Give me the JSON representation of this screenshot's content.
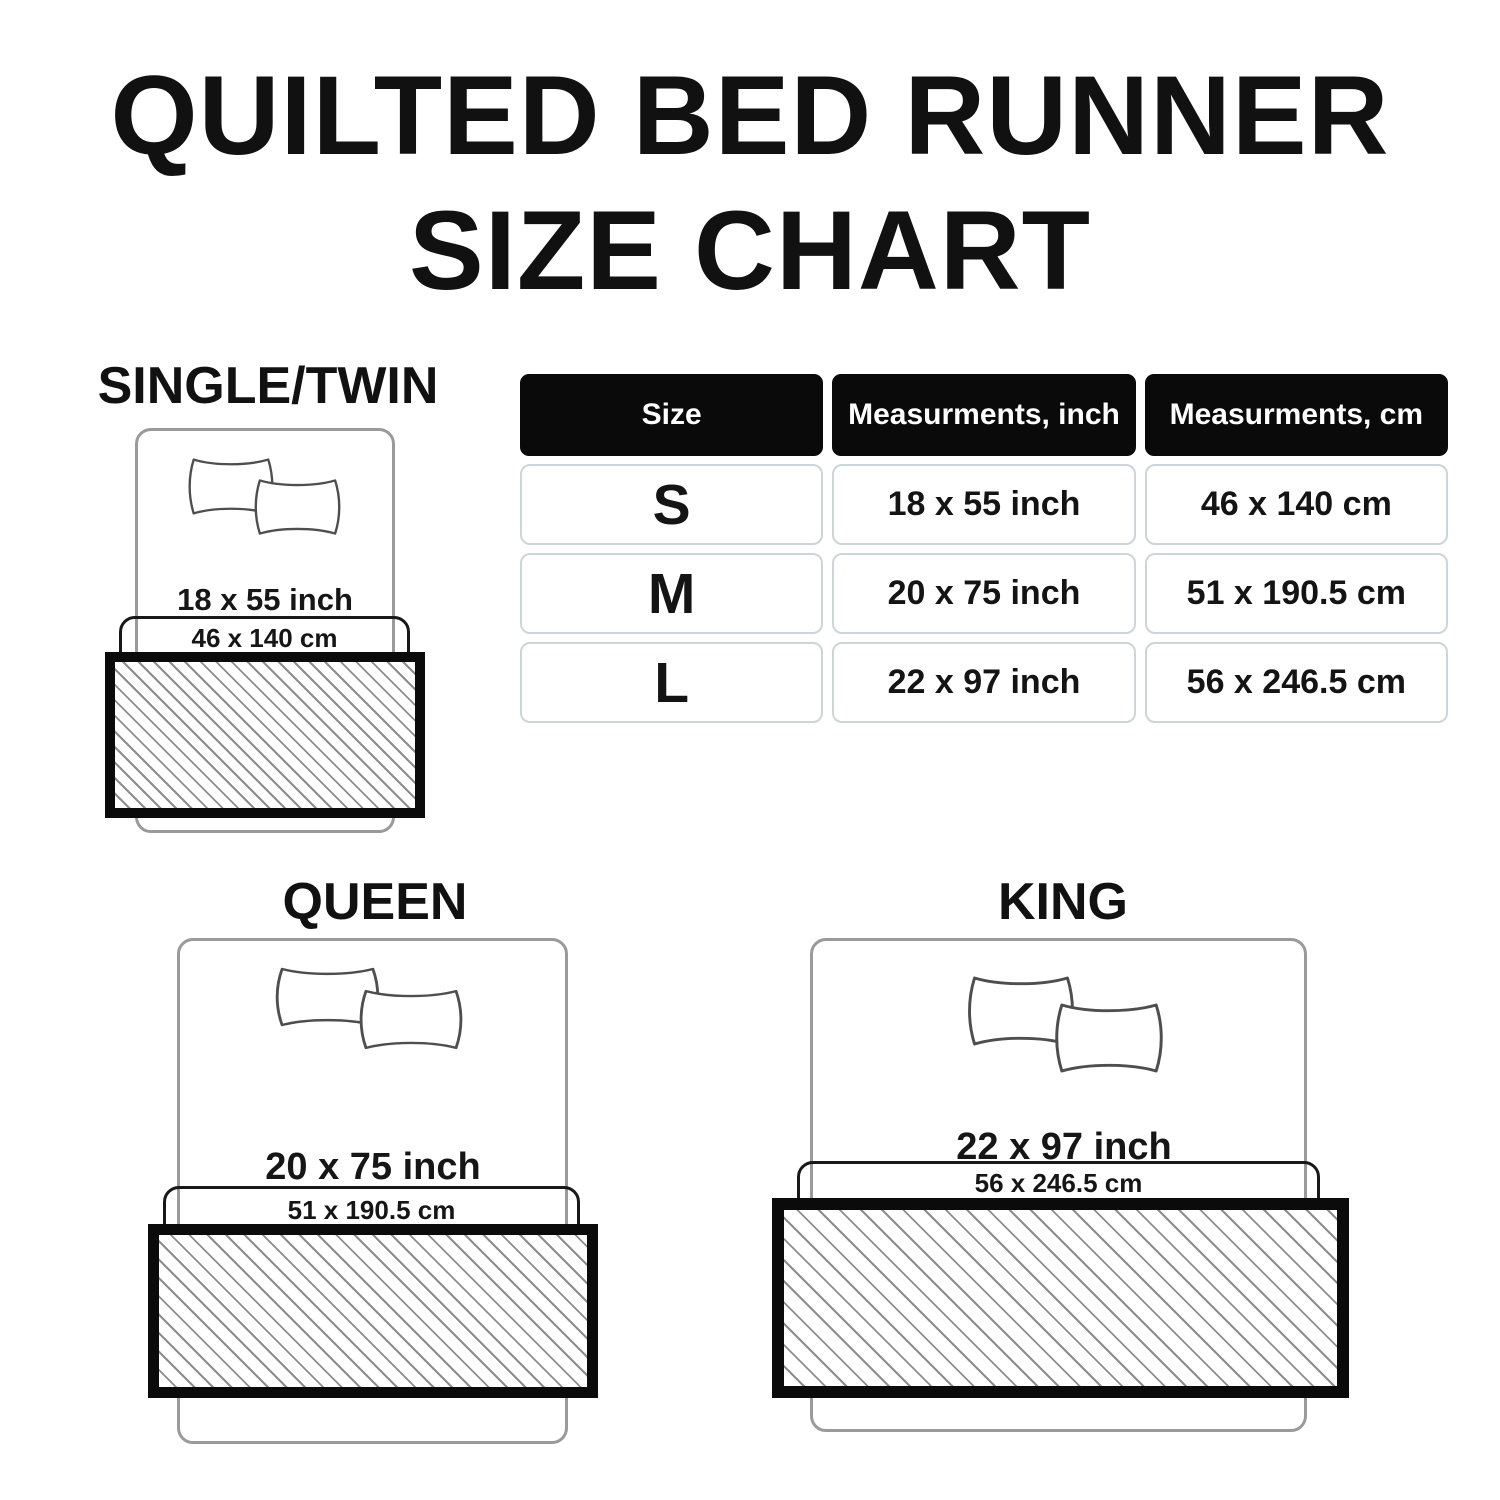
{
  "title": {
    "line1": "QUILTED BED RUNNER",
    "line2": "SIZE CHART"
  },
  "table": {
    "headers": [
      "Size",
      "Measurments, inch",
      "Measurments, cm"
    ],
    "rows": [
      {
        "size": "S",
        "inch": "18 x 55 inch",
        "cm": "46 x 140 cm"
      },
      {
        "size": "M",
        "inch": "20 x 75 inch",
        "cm": "51 x 190.5 cm"
      },
      {
        "size": "L",
        "inch": "22 x 97 inch",
        "cm": "56 x 246.5 cm"
      }
    ]
  },
  "diagrams": [
    {
      "title": "SINGLE/TWIN",
      "inch": "18 x 55 inch",
      "cm": "46 x 140 cm"
    },
    {
      "title": "QUEEN",
      "inch": "20 x 75 inch",
      "cm": "51 x 190.5 cm"
    },
    {
      "title": "KING",
      "inch": "22 x 97 inch",
      "cm": "56 x 246.5 cm"
    }
  ],
  "chart_data": {
    "type": "table",
    "title": "QUILTED BED RUNNER SIZE CHART",
    "columns": [
      "Size",
      "Measurments, inch",
      "Measurments, cm"
    ],
    "rows": [
      [
        "S",
        "18 x 55 inch",
        "46 x 140 cm"
      ],
      [
        "M",
        "20 x 75 inch",
        "51 x 190.5 cm"
      ],
      [
        "L",
        "22 x 97 inch",
        "56 x 246.5 cm"
      ]
    ]
  },
  "colors": {
    "background": "#ffffff",
    "header_bg": "#0a0a0a",
    "header_text": "#ffffff",
    "cell_border": "#ccd5d8",
    "text": "#141414",
    "bed_outline": "#9a9a9a",
    "runner_border": "#0b0b0b",
    "hatch_line": "#8d8d8d"
  }
}
